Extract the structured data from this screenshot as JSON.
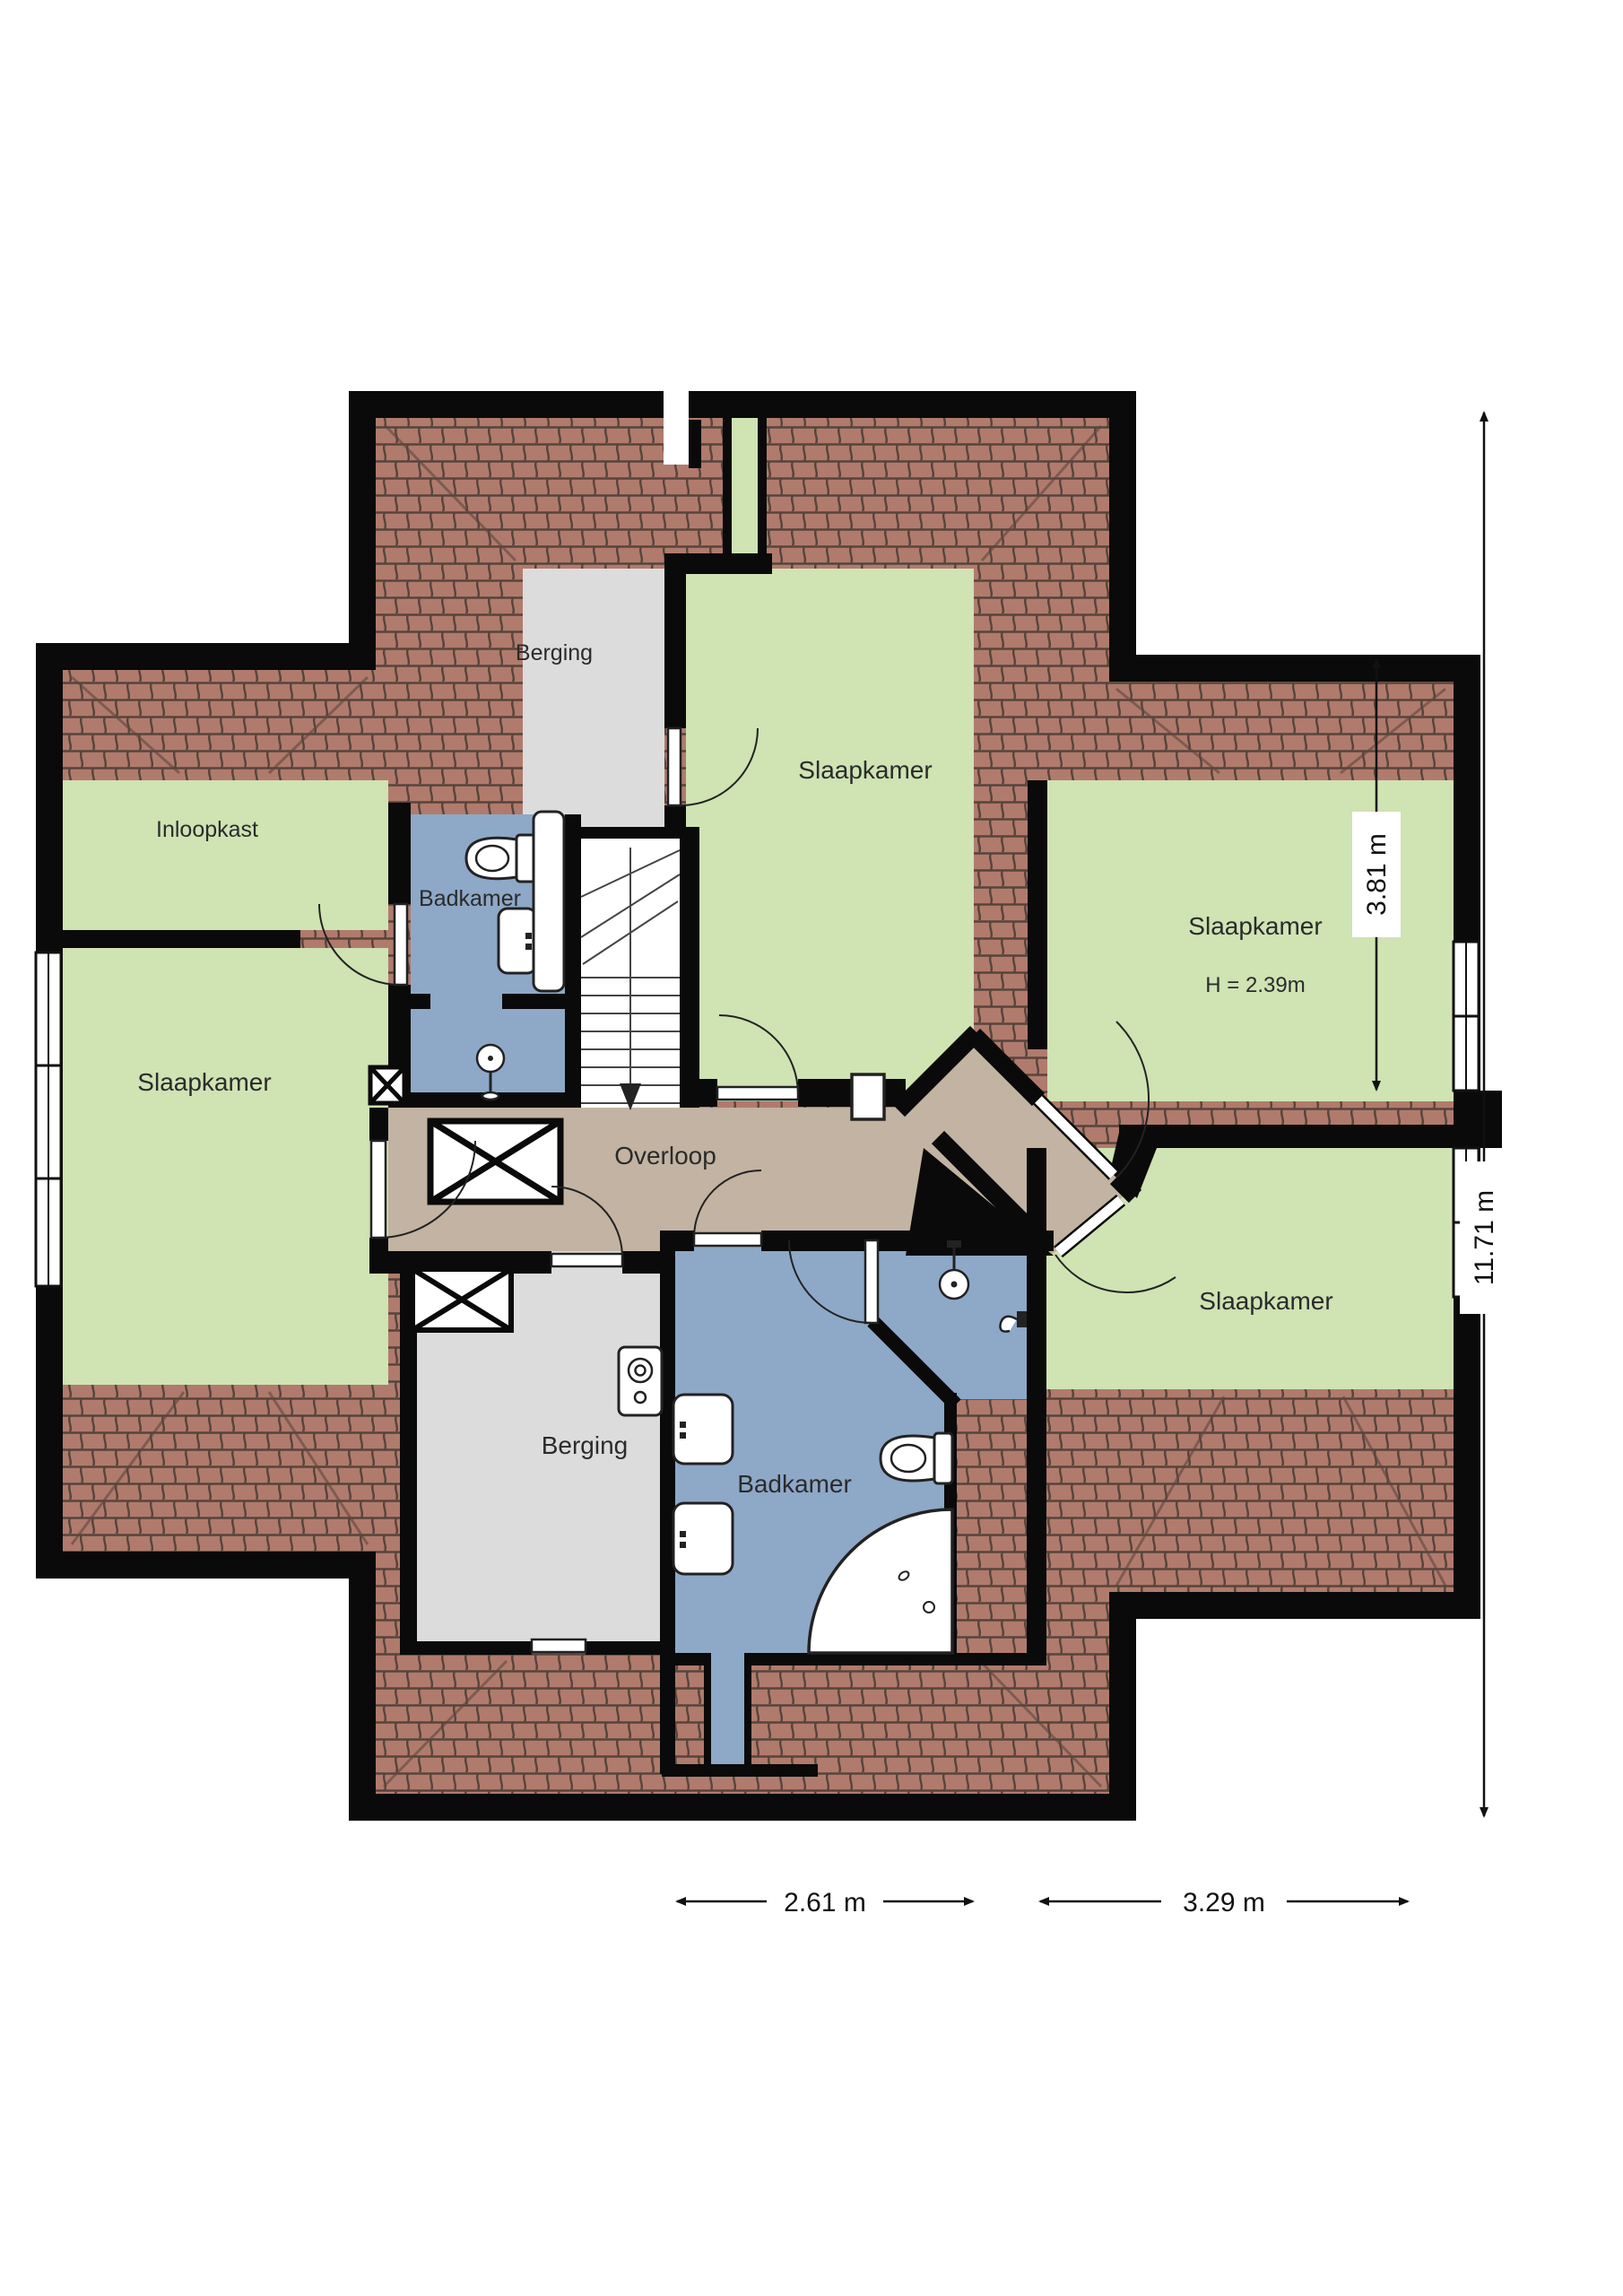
{
  "plan": {
    "type": "floorplan",
    "floor": "upper-floor",
    "rooms": {
      "berging_top": {
        "label": "Berging"
      },
      "slaapkamer_top": {
        "label": "Slaapkamer"
      },
      "inloopkast": {
        "label": "Inloopkast"
      },
      "badkamer_top": {
        "label": "Badkamer"
      },
      "slaapkamer_left": {
        "label": "Slaapkamer"
      },
      "slaapkamer_right": {
        "label": "Slaapkamer",
        "height": "H = 2.39m"
      },
      "overloop": {
        "label": "Overloop"
      },
      "berging_bottom": {
        "label": "Berging"
      },
      "badkamer_bottom": {
        "label": "Badkamer"
      },
      "slaapkamer_bottom_right": {
        "label": "Slaapkamer"
      }
    },
    "dimensions": {
      "bottom_left": "2.61 m",
      "bottom_right": "3.29 m",
      "right_inner": "3.81 m",
      "right_outer": "11.71 m"
    },
    "colors": {
      "room_green": "#cfe3b3",
      "room_gray": "#dcdcdc",
      "room_blue": "#8ea8c7",
      "hall_tan": "#c2b3a2",
      "roof_tile": "#b07b6d",
      "roof_line": "#57443b",
      "wall": "#0a0a0a"
    }
  }
}
